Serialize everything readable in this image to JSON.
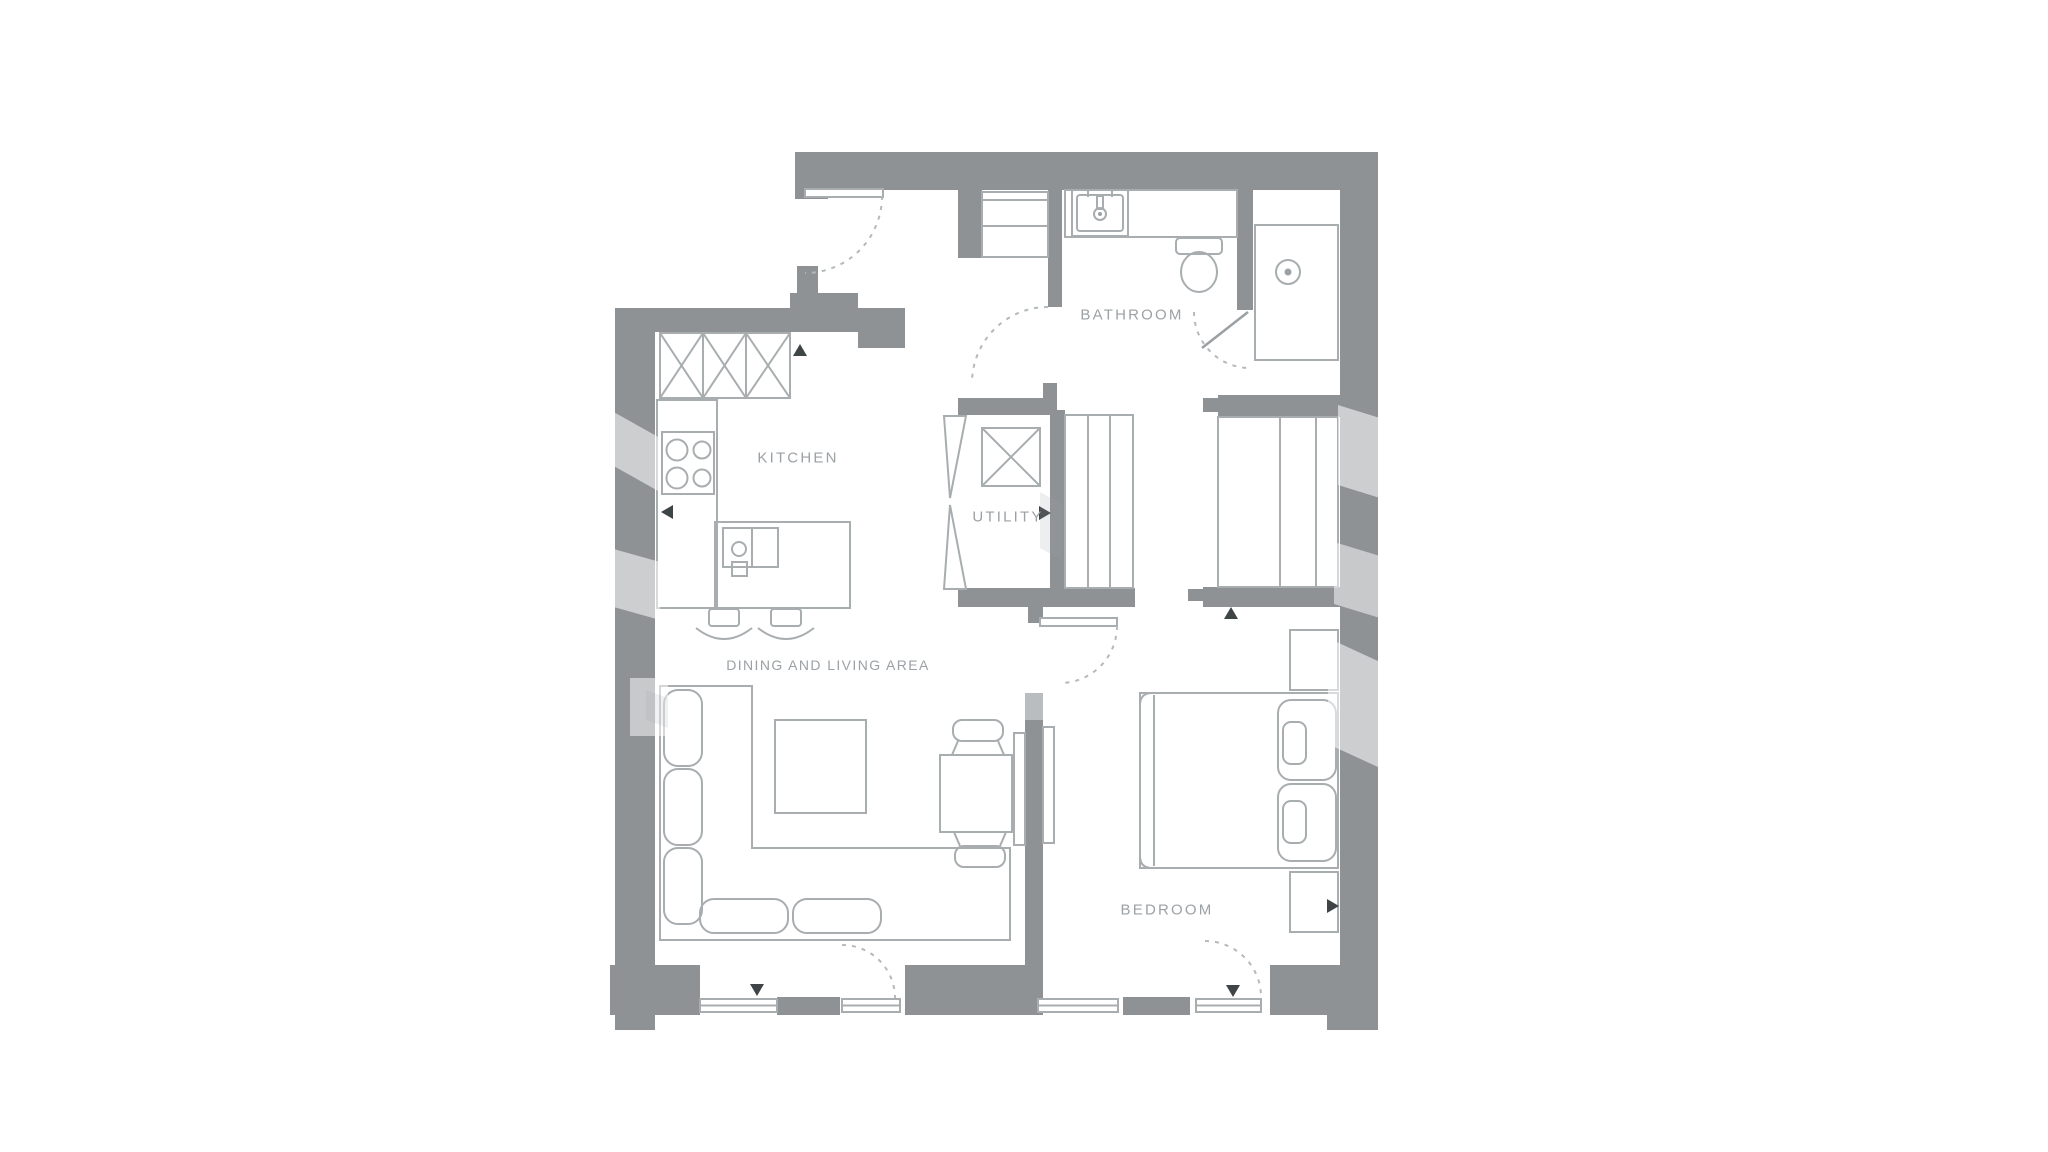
{
  "page": {
    "type": "floor-plan",
    "background": "#ffffff"
  },
  "rooms": {
    "kitchen": {
      "label": "KITCHEN"
    },
    "bathroom": {
      "label": "BATHROOM"
    },
    "utility": {
      "label": "UTILITY"
    },
    "living": {
      "label": "DINING AND LIVING AREA"
    },
    "bedroom": {
      "label": "BEDROOM"
    }
  },
  "colors": {
    "wall_gray": "#8e9295",
    "wall_light": "#b9bdbf",
    "furniture_line": "#a8adb0",
    "door_arc": "#b4b9bc",
    "label_text": "#9ba1a5",
    "arrow_marker": "#3f4447",
    "background": "#ffffff"
  },
  "fixtures": [
    "entry-door-swing",
    "hall-closet-shelves",
    "kitchen-wall-cabinets",
    "cooktop-4-burner",
    "kitchen-counter",
    "kitchen-island-sink",
    "bar-stool",
    "bar-stool",
    "sofa-l-shaped",
    "coffee-table",
    "dining-table",
    "dining-chair",
    "dining-chair",
    "tv-panel",
    "utility-appliance",
    "utility-bifold-door",
    "storage-shelving",
    "bathroom-vanity-sink",
    "toilet",
    "shower-tray-drain",
    "bathroom-door-swing",
    "bedroom-door-swing",
    "wardrobe-sliding",
    "double-bed",
    "pillow",
    "pillow",
    "nightstand",
    "nightstand",
    "window",
    "window",
    "balcony-door",
    "balcony-door"
  ],
  "markers": {
    "glyph": "triangle",
    "count": 7
  }
}
